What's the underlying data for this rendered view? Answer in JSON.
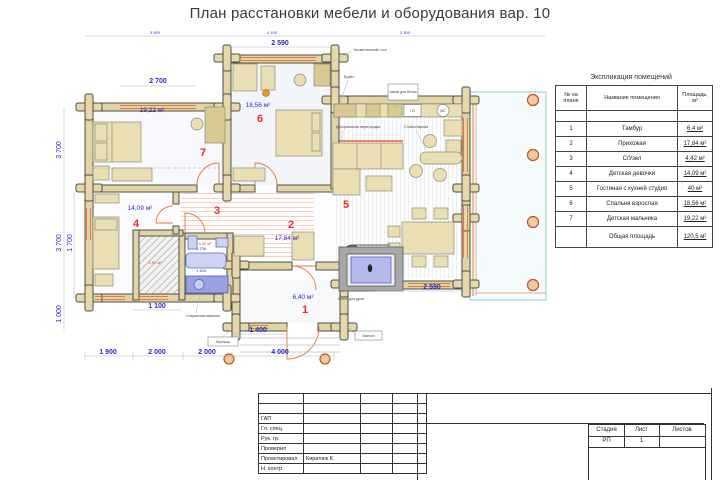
{
  "sheet": {
    "title": "План расстановки мебели и оборудования вар. 10"
  },
  "plan": {
    "rooms": {
      "r1": {
        "num": "1",
        "area": "6,40 м²"
      },
      "r2": {
        "num": "2",
        "area": "17,84 м²"
      },
      "r3": {
        "num": "3",
        "area": "4,42 м²"
      },
      "r4": {
        "num": "4",
        "area": "14,09 м²"
      },
      "r5": {
        "num": "5"
      },
      "r6": {
        "num": "6",
        "area": "18,56 м²"
      },
      "r7": {
        "num": "7",
        "area": "19,22 м²"
      }
    },
    "dims": {
      "top_a": "3 500",
      "top_b": "4 100",
      "top_c": "2 300",
      "d2590_top": "2 590",
      "d2700": "2 700",
      "v3700a": "3 700",
      "v3700b": "3 700",
      "v1700": "1 700",
      "v1000": "1 000",
      "d1100": "1 100",
      "d1400": "1 400",
      "b1900": "1 900",
      "b2000a": "2 000",
      "b2000b": "2 000",
      "b4000": "4 000",
      "d2590_bot": "2 590",
      "bath_a": "1 736",
      "bath_b": "1 400",
      "closet_area": "2,97 м²"
    },
    "callouts": {
      "cosmetic": "Косметический стол",
      "buffet": "Буфет",
      "linen": "Шкаф для белья",
      "partition": "Декоративная перегородка",
      "bar": "Стойка барная",
      "pl": "ПЛ",
      "mc": "МС",
      "washer": "Стиральная машина",
      "firewood": "Место для дров",
      "mangal": "Мангал",
      "porch": "Крыльцо"
    }
  },
  "explication": {
    "title": "Экспликация помещений",
    "col_num": "№ на плане",
    "col_name": "Название помещения",
    "col_area": "Площадь, м²",
    "rows": [
      {
        "num": "1",
        "name": "Тамбур",
        "area": "6,4 м²"
      },
      {
        "num": "2",
        "name": "Прихожая",
        "area": "17,84 м²"
      },
      {
        "num": "3",
        "name": "С/Узел",
        "area": "4,42 м²"
      },
      {
        "num": "4",
        "name": "Детская девочки",
        "area": "14,09 м²"
      },
      {
        "num": "5",
        "name": "Гостиная с кухней студио",
        "area": "40 м²"
      },
      {
        "num": "6",
        "name": "Спальня взрослая",
        "area": "18,56 м²"
      },
      {
        "num": "7",
        "name": "Детская мальчика",
        "area": "19,22 м²"
      }
    ],
    "total_label": "Общая площадь",
    "total_value": "120,5 м²"
  },
  "titleblock": {
    "roles": [
      "",
      "",
      "ГАП",
      "Гл. спец.",
      "Рук. гр.",
      "Проверил",
      "Проектировал",
      "Н. контр."
    ],
    "designer": "Кирилюк К.",
    "stage_label": "Стадия",
    "sheet_label": "Лист",
    "sheets_label": "Листов",
    "stage": "РП",
    "sheet_no": "1",
    "sheets": ""
  }
}
